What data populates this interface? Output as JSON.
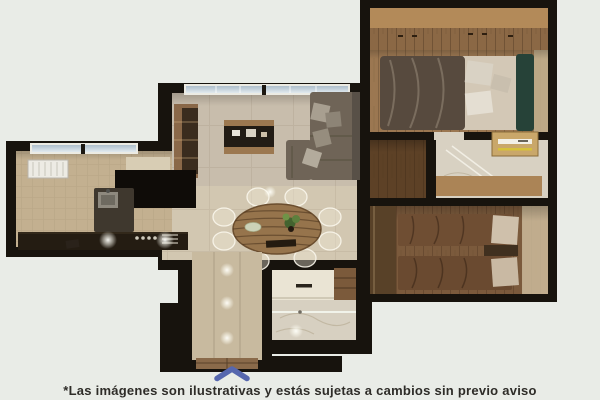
{
  "page": {
    "background_color": "#e9ece7"
  },
  "floor_plan": {
    "kind": "apartment-top-view-render",
    "rooms": [
      "living-room",
      "dining-area",
      "kitchen",
      "entrance-hall",
      "bathroom-main",
      "hall-closet",
      "bathroom-secondary",
      "bedroom-master",
      "bedroom-secondary"
    ],
    "furniture": [
      "sofa",
      "tv-console",
      "round-dining-table",
      "ghost-chairs",
      "kitchen-counter",
      "kitchen-island-sink",
      "stove-burners",
      "radiator",
      "double-bed",
      "wardrobe",
      "twin-bed-1",
      "twin-bed-2",
      "nightstand",
      "vanity",
      "shower-glass",
      "entrance-door"
    ],
    "colors": {
      "wall": "#17130d",
      "tile_floor": "#d2c7b1",
      "wood_floor": "#9b7751",
      "marble_floor": "#d8d1c2",
      "window_glass": "#bfd2dd",
      "wardrobe_tan": "#b38a59",
      "headboard_green": "#264238"
    }
  },
  "footer": {
    "chevron_icon": "chevron-up",
    "chevron_color": "#5667ae",
    "disclaimer": "*Las imágenes son ilustrativas y estás sujetas a cambios sin previo aviso",
    "text_color": "#2e2c28"
  }
}
